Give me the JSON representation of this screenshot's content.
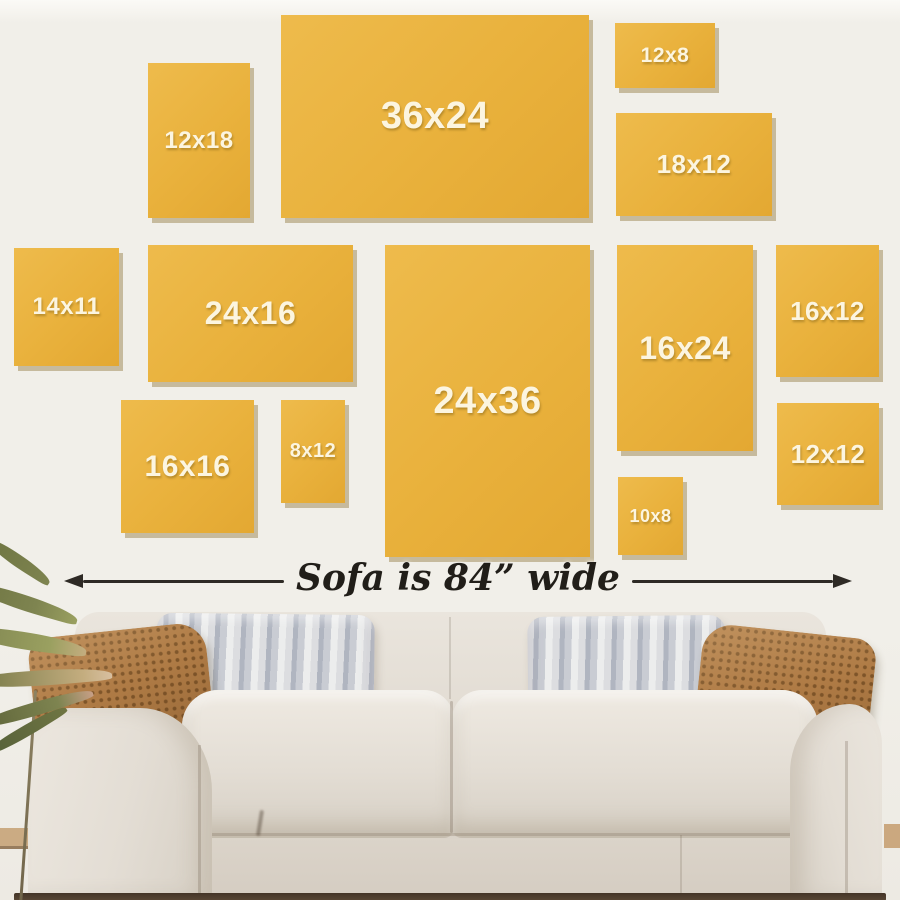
{
  "frames": [
    {
      "id": "12x18",
      "label": "12x18"
    },
    {
      "id": "36x24",
      "label": "36x24"
    },
    {
      "id": "12x8",
      "label": "12x8"
    },
    {
      "id": "18x12",
      "label": "18x12"
    },
    {
      "id": "14x11",
      "label": "14x11"
    },
    {
      "id": "24x16",
      "label": "24x16"
    },
    {
      "id": "24x36",
      "label": "24x36"
    },
    {
      "id": "16x24",
      "label": "16x24"
    },
    {
      "id": "16x12",
      "label": "16x12"
    },
    {
      "id": "16x16",
      "label": "16x16"
    },
    {
      "id": "8x12",
      "label": "8x12"
    },
    {
      "id": "10x8",
      "label": "10x8"
    },
    {
      "id": "12x12",
      "label": "12x12"
    }
  ],
  "dimension_label": {
    "text": "Sofa is 84” wide"
  },
  "colors": {
    "wall": "#F1EFE9",
    "frame-yellow": "#E9B13C",
    "frame-yellow-light": "#EEBB4C",
    "label-text": "#FCF5E0",
    "arrow": "#2E2A25",
    "note-text": "#211E19",
    "sofa-fabric": "#E3DDD4",
    "sofa-fabric-dark": "#D6CFC4",
    "pillow-rust": "#AF7B45",
    "pillow-gray": "#C9CCD3",
    "pillow-gray-stripe": "#B0B5C0",
    "plant-olive": "#7E8450",
    "plant-tan": "#C4AD7F",
    "floor-wood": "#C6A173",
    "floor-shadow": "#443527"
  }
}
